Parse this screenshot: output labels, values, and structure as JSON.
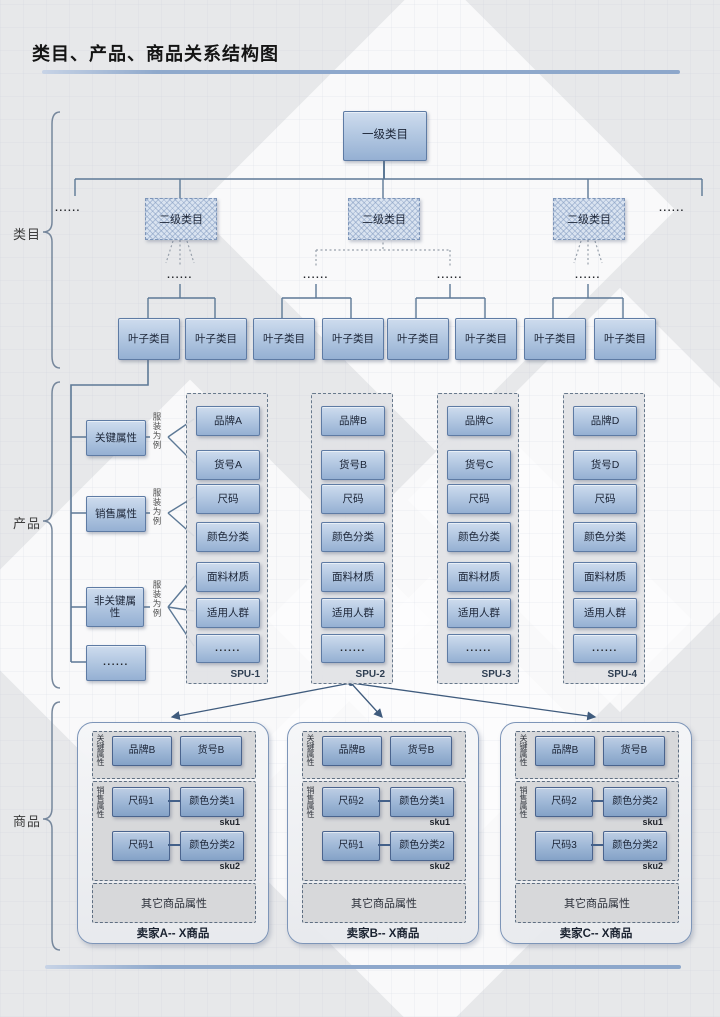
{
  "title": "类目、产品、商品关系结构图",
  "ellipsis": "......",
  "sections": {
    "category": "类目",
    "product": "产品",
    "commodity": "商品"
  },
  "category": {
    "level1": "一级类目",
    "level2": [
      "二级类目",
      "二级类目",
      "二级类目"
    ],
    "leaves": [
      "叶子类目",
      "叶子类目",
      "叶子类目",
      "叶子类目",
      "叶子类目",
      "叶子类目",
      "叶子类目",
      "叶子类目"
    ]
  },
  "product": {
    "groups": [
      {
        "label": "关键属性",
        "note": "服装为例"
      },
      {
        "label": "销售属性",
        "note": "服装为例"
      },
      {
        "label": "非关键属性",
        "note": "服装为例"
      },
      {
        "label": "......",
        "note": ""
      }
    ],
    "spus": [
      {
        "name": "SPU-1",
        "items": [
          "品牌A",
          "货号A",
          "尺码",
          "颜色分类",
          "面料材质",
          "适用人群",
          "......"
        ]
      },
      {
        "name": "SPU-2",
        "items": [
          "品牌B",
          "货号B",
          "尺码",
          "颜色分类",
          "面料材质",
          "适用人群",
          "......"
        ]
      },
      {
        "name": "SPU-3",
        "items": [
          "品牌C",
          "货号C",
          "尺码",
          "颜色分类",
          "面料材质",
          "适用人群",
          "......"
        ]
      },
      {
        "name": "SPU-4",
        "items": [
          "品牌D",
          "货号D",
          "尺码",
          "颜色分类",
          "面料材质",
          "适用人群",
          "......"
        ]
      }
    ]
  },
  "commodity": {
    "sellers": [
      {
        "name": "卖家A-- X商品",
        "key_label": "关键属性",
        "brand": "品牌B",
        "item_no": "货号B",
        "sales_label": "销售属性",
        "other": "其它商品属性",
        "skus": [
          {
            "size": "尺码1",
            "color": "颜色分类1",
            "tag": "sku1"
          },
          {
            "size": "尺码1",
            "color": "颜色分类2",
            "tag": "sku2"
          }
        ]
      },
      {
        "name": "卖家B-- X商品",
        "key_label": "关键属性",
        "brand": "品牌B",
        "item_no": "货号B",
        "sales_label": "销售属性",
        "other": "其它商品属性",
        "skus": [
          {
            "size": "尺码2",
            "color": "颜色分类1",
            "tag": "sku1"
          },
          {
            "size": "尺码1",
            "color": "颜色分类2",
            "tag": "sku2"
          }
        ]
      },
      {
        "name": "卖家C-- X商品",
        "key_label": "关键属性",
        "brand": "品牌B",
        "item_no": "货号B",
        "sales_label": "销售属性",
        "other": "其它商品属性",
        "skus": [
          {
            "size": "尺码2",
            "color": "颜色分类2",
            "tag": "sku1"
          },
          {
            "size": "尺码3",
            "color": "颜色分类2",
            "tag": "sku2"
          }
        ]
      }
    ]
  },
  "colors": {
    "accent_rule": "#8fa9cc",
    "box_blue_top": "#cedcee",
    "box_blue_bottom": "#95b0d3",
    "box_border": "#5e7ba4",
    "connector": "#5d7996",
    "arrow": "#3f5b7d"
  }
}
